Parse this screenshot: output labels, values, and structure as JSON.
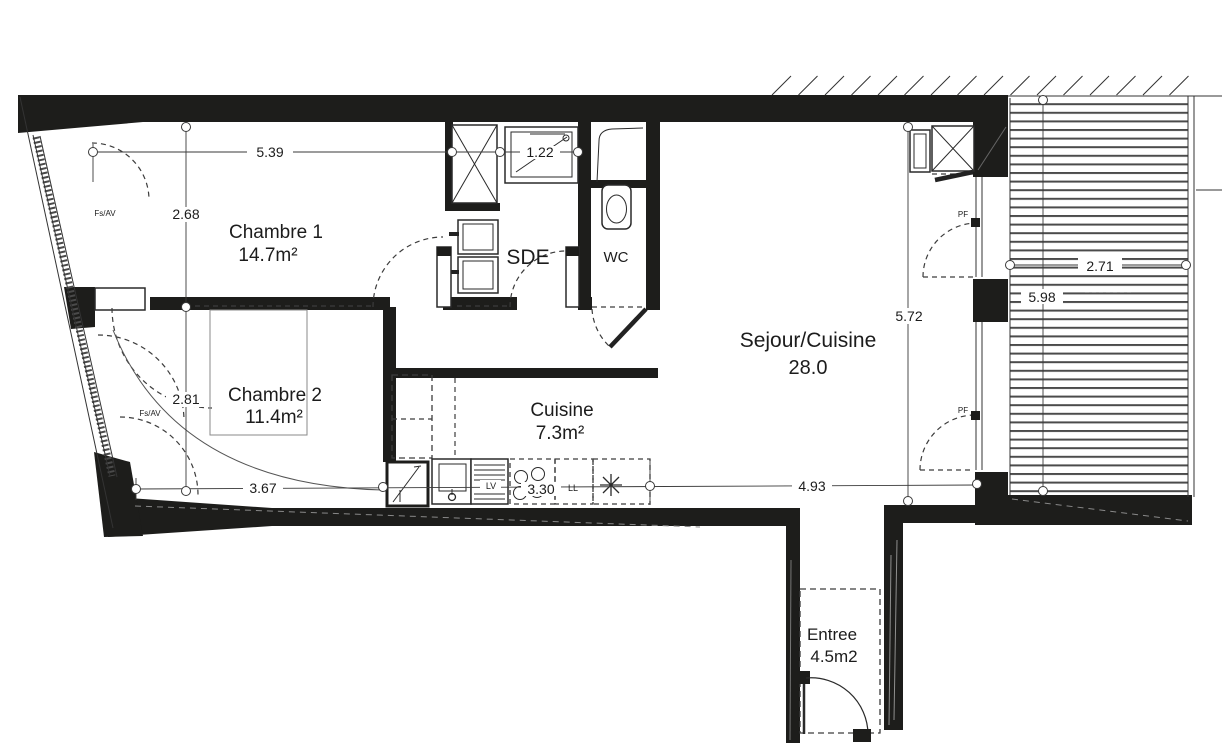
{
  "plan": {
    "rooms": {
      "chambre1": {
        "label": "Chambre 1",
        "area": "14.7m²"
      },
      "chambre2": {
        "label": "Chambre 2",
        "area": "11.4m²"
      },
      "sde": {
        "label": "SDE"
      },
      "wc": {
        "label": "WC"
      },
      "sejour": {
        "label": "Sejour/Cuisine",
        "area": "28.0"
      },
      "cuisine": {
        "label": "Cuisine",
        "area": "7.3m²"
      },
      "entree": {
        "label": "Entree",
        "area": "4.5m2"
      }
    },
    "dims": {
      "top_width": "5.39",
      "shower_width": "1.22",
      "ch1_height": "2.68",
      "ch2_height": "2.81",
      "ch2_width": "3.67",
      "kitchen_width": "3.30",
      "sejour_width": "4.93",
      "sejour_height": "5.72",
      "balcony_width": "2.71",
      "balcony_height": "5.98"
    },
    "tags": {
      "fs_av": "Fs/AV",
      "pf": "PF",
      "lv": "LV",
      "ll": "LL"
    }
  },
  "colors": {
    "wall": "#1d1d1b",
    "line": "#333333",
    "deck_slat": "#4b4b4b",
    "background": "#ffffff"
  }
}
